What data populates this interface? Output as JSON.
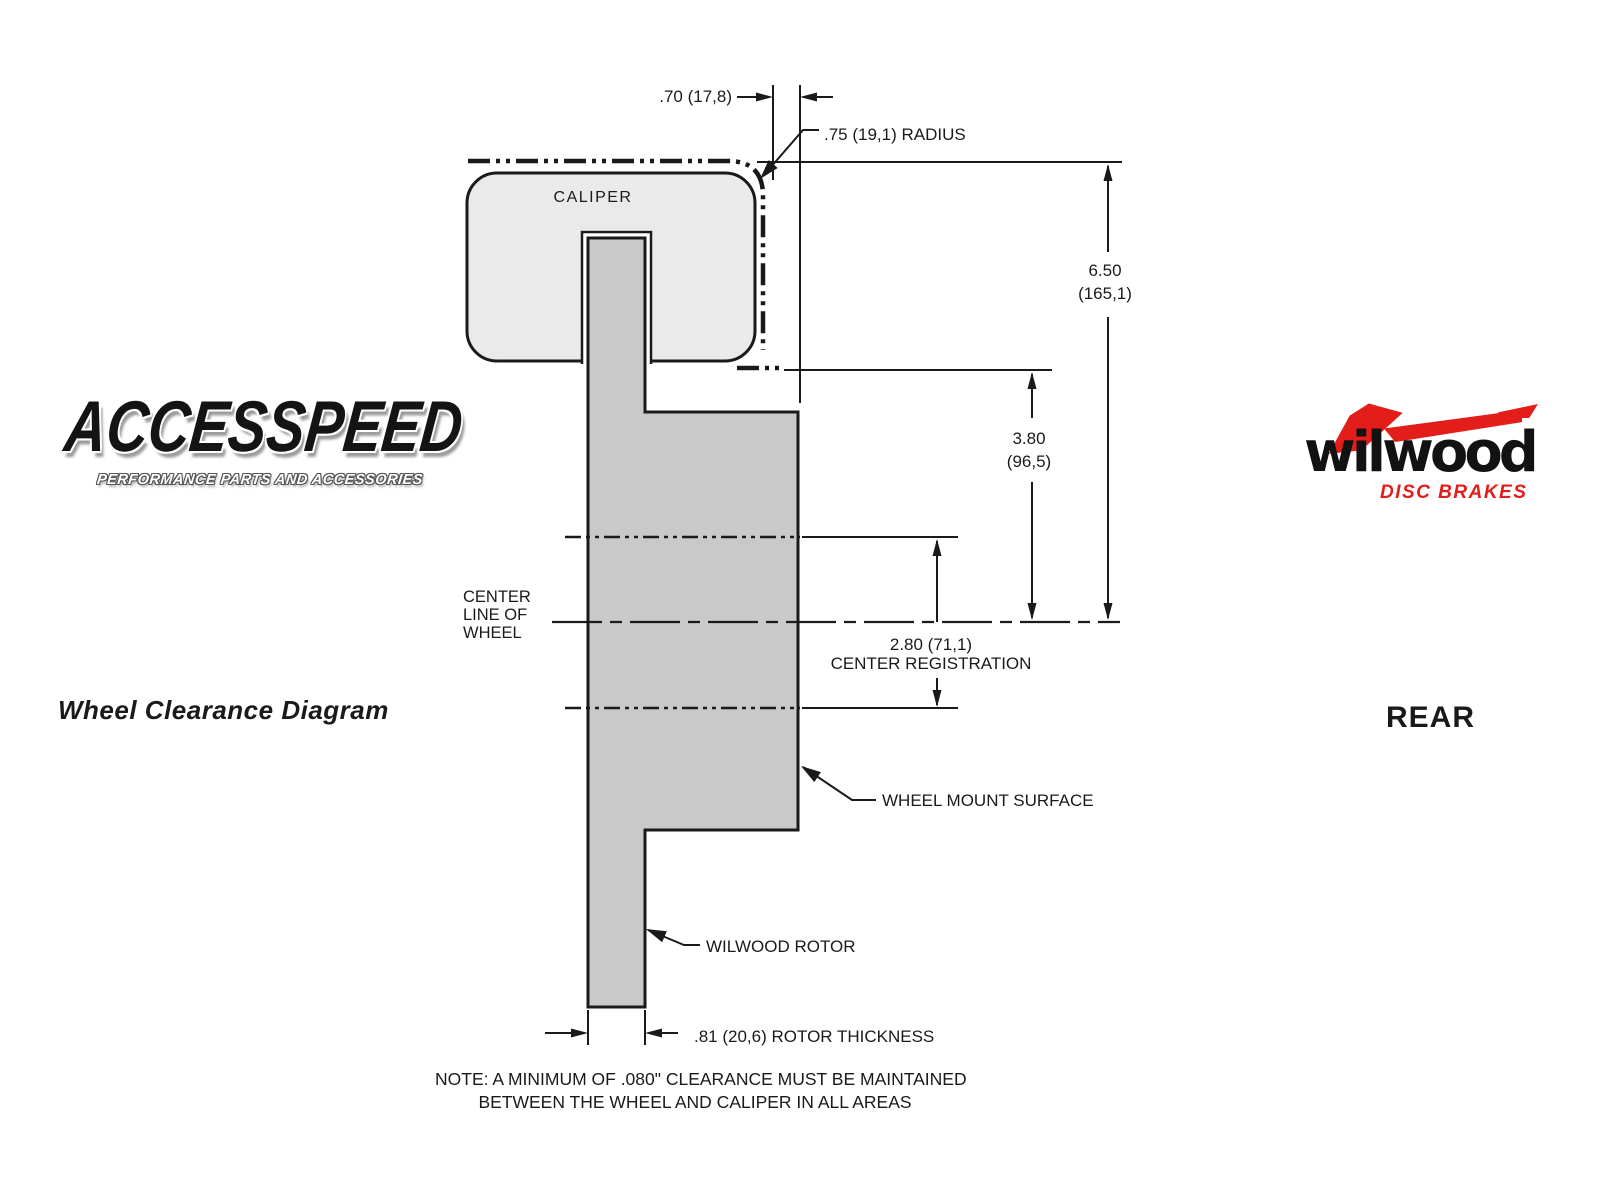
{
  "colors": {
    "line": "#1a1a1a",
    "caliper_fill": "#eaeaea",
    "rotor_fill": "#c9c9c9",
    "brand_red": "#e31d1a"
  },
  "branding": {
    "accesspeed": {
      "name": "ACCESSPEED",
      "tagline": "PERFORMANCE PARTS AND ACCESSORIES"
    },
    "wilwood": {
      "name": "wilwood",
      "tagline": "DISC BRAKES"
    }
  },
  "titles": {
    "diagram_title": "Wheel Clearance Diagram",
    "position_label": "REAR"
  },
  "diagram": {
    "caliper_label": "CALIPER",
    "centerline_label_lines": [
      "CENTER",
      "LINE OF",
      "WHEEL"
    ],
    "labels": {
      "wheel_mount_surface": "WHEEL MOUNT SURFACE",
      "wilwood_rotor": "WILWOOD ROTOR"
    },
    "dimensions": {
      "caliper_overhang": ".70 (17,8)",
      "radius": ".75 (19,1) RADIUS",
      "mount_to_top": [
        "6.50",
        "(165,1)"
      ],
      "mount_to_hat": [
        "3.80",
        "(96,5)"
      ],
      "center_registration": [
        "2.80 (71,1)",
        "CENTER REGISTRATION"
      ],
      "rotor_thickness": ".81 (20,6) ROTOR THICKNESS"
    },
    "note_lines": [
      "NOTE: A MINIMUM OF .080\" CLEARANCE MUST BE MAINTAINED",
      "BETWEEN THE WHEEL AND CALIPER IN ALL AREAS"
    ]
  }
}
